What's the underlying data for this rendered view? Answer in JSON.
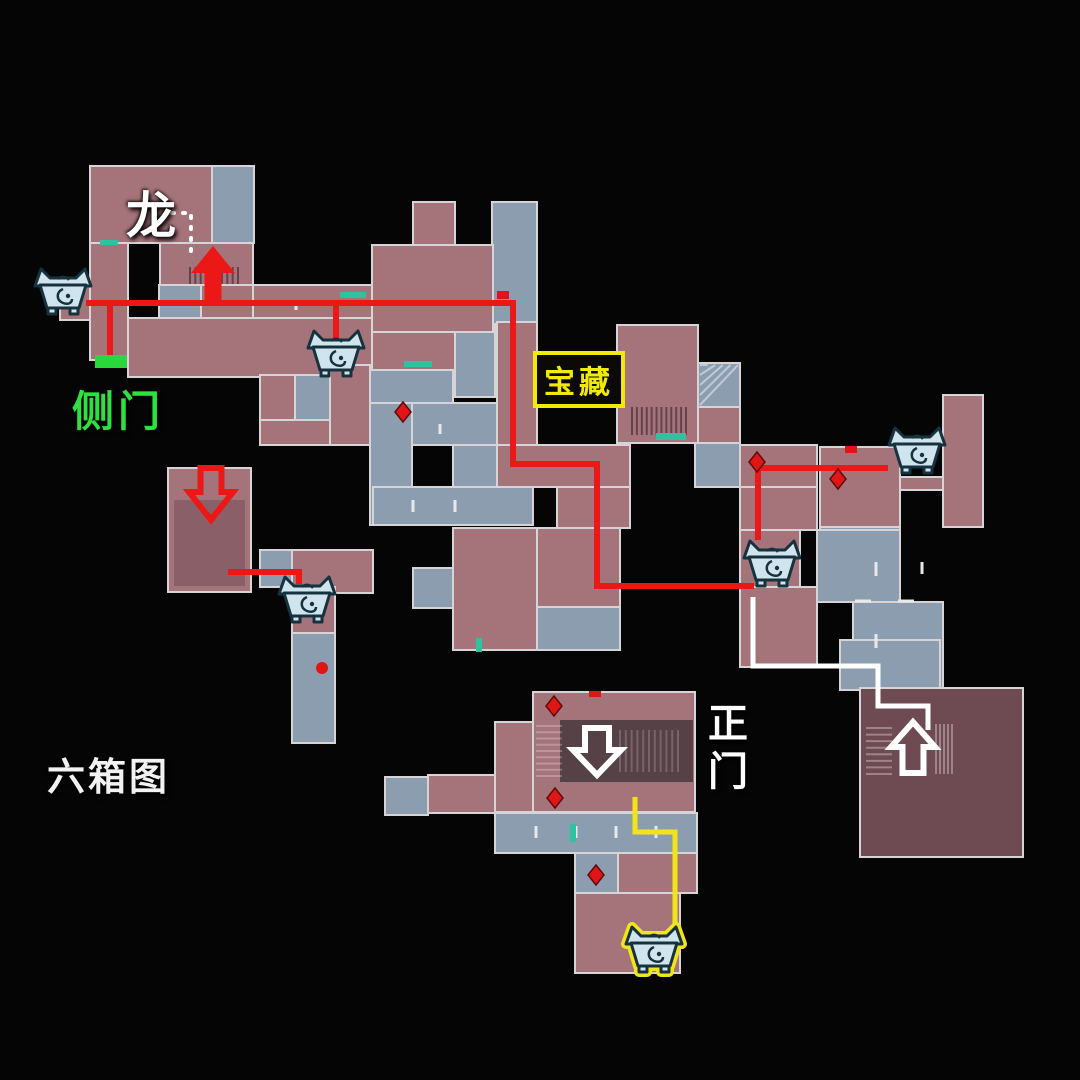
{
  "map": {
    "labels": {
      "dragon": {
        "text": "龙"
      },
      "side_door": {
        "text": "侧门"
      },
      "treasure": {
        "text": "宝藏"
      },
      "main_gate": {
        "text": "正门"
      },
      "caption": {
        "text": "六箱图"
      }
    },
    "colors": {
      "background": "#060505",
      "room_pink": "#a5737a",
      "room_blue": "#8d9db0",
      "room_maroon": "#6e4b53",
      "hall_inner": "#564147",
      "room_pink_dark": "#8a5f68",
      "wall": "#d6d4d6",
      "route_red": "#ec1717",
      "route_white": "#ffffff",
      "route_yellow": "#f2e41c",
      "side_door_green": "#2bd83a",
      "chest_fill": "#cfe4ec",
      "chest_stroke": "#16323e",
      "chest_glow": "#f0e41a",
      "label_yellow": "#f2ea06",
      "marker_red": "#e01616",
      "door_teal": "#2ec3a0"
    },
    "rooms": [
      [
        90,
        166,
        122,
        77,
        "p"
      ],
      [
        212,
        166,
        42,
        77,
        "b"
      ],
      [
        60,
        284,
        30,
        36,
        "p"
      ],
      [
        90,
        243,
        38,
        117,
        "p"
      ],
      [
        160,
        243,
        93,
        42,
        "p"
      ],
      [
        159,
        285,
        42,
        33,
        "b"
      ],
      [
        201,
        285,
        52,
        33,
        "p"
      ],
      [
        253,
        285,
        120,
        38,
        "p"
      ],
      [
        128,
        318,
        245,
        59,
        "p"
      ],
      [
        260,
        375,
        35,
        45,
        "p"
      ],
      [
        295,
        375,
        40,
        45,
        "b"
      ],
      [
        260,
        420,
        113,
        25,
        "p"
      ],
      [
        330,
        365,
        42,
        80,
        "p"
      ],
      [
        370,
        365,
        83,
        38,
        "b"
      ],
      [
        455,
        325,
        40,
        72,
        "b"
      ],
      [
        370,
        403,
        42,
        122,
        "b"
      ],
      [
        412,
        403,
        85,
        42,
        "b"
      ],
      [
        453,
        445,
        44,
        42,
        "b"
      ],
      [
        373,
        487,
        160,
        38,
        "b"
      ],
      [
        492,
        202,
        45,
        122,
        "b"
      ],
      [
        497,
        322,
        40,
        165,
        "p"
      ],
      [
        413,
        202,
        42,
        45,
        "p"
      ],
      [
        372,
        245,
        121,
        87,
        "p"
      ],
      [
        372,
        332,
        83,
        38,
        "p"
      ],
      [
        617,
        325,
        81,
        118,
        "p"
      ],
      [
        698,
        363,
        42,
        44,
        "b"
      ],
      [
        698,
        407,
        42,
        36,
        "p"
      ],
      [
        695,
        443,
        45,
        44,
        "b"
      ],
      [
        740,
        445,
        77,
        42,
        "p"
      ],
      [
        820,
        447,
        80,
        80,
        "p"
      ],
      [
        820,
        527,
        80,
        33,
        "b"
      ],
      [
        943,
        395,
        40,
        132,
        "p"
      ],
      [
        900,
        477,
        43,
        13,
        "p"
      ],
      [
        740,
        487,
        77,
        43,
        "p"
      ],
      [
        740,
        530,
        60,
        57,
        "p"
      ],
      [
        817,
        530,
        83,
        72,
        "b"
      ],
      [
        853,
        602,
        90,
        88,
        "b"
      ],
      [
        840,
        640,
        100,
        50,
        "b"
      ],
      [
        740,
        587,
        77,
        80,
        "p"
      ],
      [
        537,
        528,
        83,
        79,
        "p"
      ],
      [
        537,
        607,
        83,
        43,
        "b"
      ],
      [
        453,
        528,
        84,
        122,
        "p"
      ],
      [
        413,
        568,
        40,
        40,
        "b"
      ],
      [
        557,
        487,
        73,
        41,
        "p"
      ],
      [
        497,
        445,
        133,
        42,
        "p"
      ],
      [
        260,
        550,
        32,
        37,
        "b"
      ],
      [
        292,
        550,
        81,
        43,
        "p"
      ],
      [
        292,
        587,
        43,
        46,
        "p"
      ],
      [
        292,
        633,
        43,
        110,
        "b"
      ],
      [
        168,
        468,
        83,
        124,
        "p"
      ],
      [
        174,
        500,
        71,
        86,
        "p2",
        0
      ],
      [
        533,
        692,
        162,
        120,
        "p"
      ],
      [
        560,
        720,
        133,
        62,
        "d",
        0
      ],
      [
        495,
        722,
        38,
        90,
        "p"
      ],
      [
        428,
        775,
        67,
        38,
        "p"
      ],
      [
        385,
        777,
        43,
        38,
        "b"
      ],
      [
        495,
        813,
        202,
        40,
        "b"
      ],
      [
        575,
        853,
        43,
        40,
        "b"
      ],
      [
        618,
        853,
        79,
        40,
        "p"
      ],
      [
        575,
        893,
        105,
        80,
        "p"
      ],
      [
        860,
        688,
        163,
        169,
        "m"
      ]
    ],
    "routes": {
      "red": [
        "M86,303 H513 V464 H597 V586 H754",
        "M110,300 V356",
        "M336,303 V350",
        "M888,468 H758 V540",
        "M228,572 H299 V584"
      ],
      "white": [
        "M753,597 V666 H878 V706 H928 V730"
      ],
      "yellow": [
        "M635,797 V832 H675 V930"
      ],
      "white_dotted": [
        "M172,213 H191 V258"
      ]
    },
    "arrows": [
      {
        "cx": 213,
        "tip": 246,
        "dir": "up",
        "W": 44,
        "H": 27,
        "sw": 17,
        "sh": 32,
        "fill": "red"
      },
      {
        "cx": 211,
        "tip": 520,
        "dir": "down",
        "W": 44,
        "H": 28,
        "sw": 21,
        "sh": 24,
        "stroke": "red"
      },
      {
        "cx": 597,
        "tip": 775,
        "dir": "down",
        "W": 48,
        "H": 25,
        "sw": 24,
        "sh": 22,
        "stroke": "white"
      },
      {
        "cx": 913,
        "tip": 722,
        "dir": "up",
        "W": 44,
        "H": 25,
        "sw": 21,
        "sh": 26,
        "stroke": "white"
      }
    ],
    "chests": [
      {
        "x": 63,
        "y": 293
      },
      {
        "x": 336,
        "y": 355
      },
      {
        "x": 917,
        "y": 452
      },
      {
        "x": 307,
        "y": 601
      },
      {
        "x": 772,
        "y": 565
      },
      {
        "x": 654,
        "y": 951,
        "hl": true
      }
    ],
    "side_door_marker": {
      "x": 95,
      "y": 355,
      "w": 32,
      "h": 13
    },
    "diamonds": [
      {
        "x": 757,
        "y": 462
      },
      {
        "x": 838,
        "y": 479
      },
      {
        "x": 554,
        "y": 706
      },
      {
        "x": 555,
        "y": 798
      },
      {
        "x": 596,
        "y": 875
      },
      {
        "x": 403,
        "y": 412
      }
    ],
    "red_rects": [
      {
        "x": 497,
        "y": 291,
        "w": 12,
        "h": 8
      },
      {
        "x": 845,
        "y": 446,
        "w": 12,
        "h": 7
      },
      {
        "x": 589,
        "y": 691,
        "w": 12,
        "h": 6
      }
    ],
    "red_dot": {
      "x": 322,
      "y": 668,
      "r": 6
    },
    "teal_doors": [
      {
        "x": 100,
        "y": 240,
        "w": 18,
        "h": 5
      },
      {
        "x": 340,
        "y": 292,
        "w": 26,
        "h": 6
      },
      {
        "x": 404,
        "y": 361,
        "w": 28,
        "h": 6
      },
      {
        "x": 656,
        "y": 433,
        "w": 30,
        "h": 7
      },
      {
        "x": 570,
        "y": 824,
        "w": 6,
        "h": 18
      },
      {
        "x": 476,
        "y": 638,
        "w": 6,
        "h": 14
      }
    ],
    "wall_ticks": [
      {
        "x": 876,
        "y": 562,
        "o": "v",
        "l": 14
      },
      {
        "x": 876,
        "y": 634,
        "o": "v",
        "l": 14
      },
      {
        "x": 855,
        "y": 601,
        "o": "h",
        "l": 16
      },
      {
        "x": 898,
        "y": 601,
        "o": "h",
        "l": 16
      },
      {
        "x": 922,
        "y": 562,
        "o": "v",
        "l": 12
      },
      {
        "x": 413,
        "y": 500,
        "o": "v",
        "l": 12
      },
      {
        "x": 455,
        "y": 500,
        "o": "v",
        "l": 12
      },
      {
        "x": 536,
        "y": 826,
        "o": "v",
        "l": 12
      },
      {
        "x": 576,
        "y": 826,
        "o": "v",
        "l": 12
      },
      {
        "x": 616,
        "y": 826,
        "o": "v",
        "l": 12
      },
      {
        "x": 656,
        "y": 826,
        "o": "v",
        "l": 12
      },
      {
        "x": 440,
        "y": 424,
        "o": "v",
        "l": 10
      },
      {
        "x": 296,
        "y": 300,
        "o": "v",
        "l": 10
      }
    ],
    "textures": [
      {
        "x": 190,
        "y": 267,
        "w": 48,
        "h": 17,
        "o": "v",
        "n": 10,
        "c": "rgba(35,22,26,0.5)"
      },
      {
        "x": 632,
        "y": 407,
        "w": 54,
        "h": 28,
        "o": "v",
        "n": 12,
        "c": "rgba(35,22,26,0.5)"
      },
      {
        "x": 866,
        "y": 728,
        "w": 26,
        "h": 46,
        "o": "h",
        "n": 8,
        "c": "rgba(235,225,230,0.38)"
      },
      {
        "x": 936,
        "y": 724,
        "w": 16,
        "h": 50,
        "o": "v",
        "n": 5,
        "c": "rgba(235,225,230,0.38)"
      },
      {
        "x": 536,
        "y": 726,
        "w": 26,
        "h": 50,
        "o": "h",
        "n": 9,
        "c": "rgba(235,225,230,0.3)"
      },
      {
        "x": 620,
        "y": 730,
        "w": 58,
        "h": 42,
        "o": "v",
        "n": 11,
        "c": "rgba(235,225,230,0.22)"
      },
      {
        "x": 700,
        "y": 365,
        "w": 38,
        "h": 40,
        "o": "d",
        "n": 5,
        "c": "rgba(245,245,250,0.5)"
      }
    ]
  }
}
